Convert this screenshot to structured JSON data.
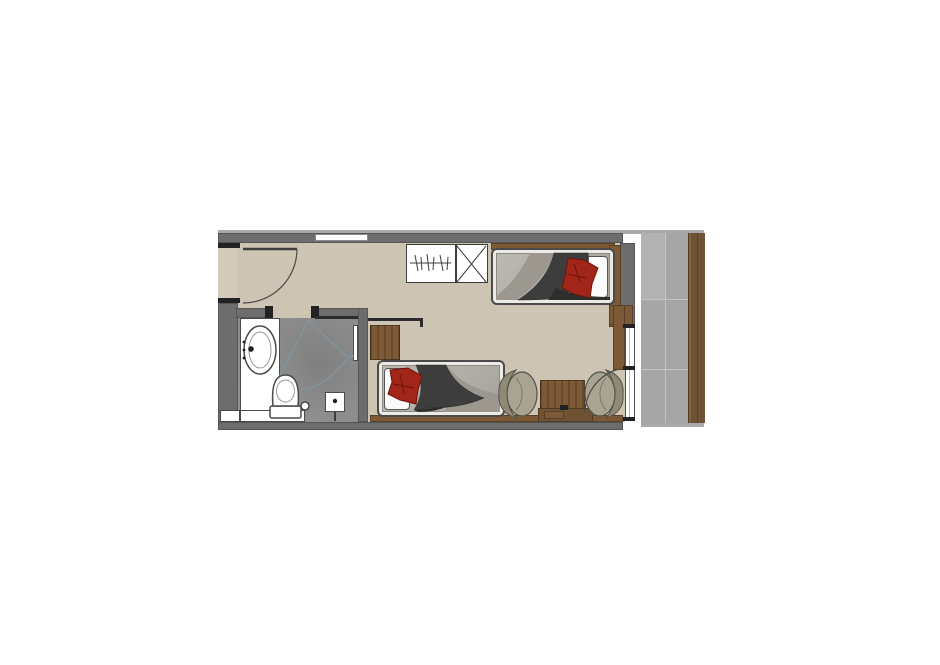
{
  "document": {
    "kind": "hotel-room-floor-plan",
    "visible_text": []
  },
  "plan": {
    "rooms": [
      "entry",
      "bathroom",
      "bedroom",
      "balcony"
    ],
    "furniture": [
      "entry-door",
      "bathroom-sliding-door",
      "vanity-sink",
      "toilet",
      "shower",
      "shower-glass-panel",
      "wardrobe-hanging-rail",
      "wardrobe-shelf-unit",
      "bed-1",
      "bed-2",
      "nightstand",
      "luggage-rack",
      "sideboard-ledge",
      "coffee-table",
      "media-box",
      "armchair-left",
      "armchair-right",
      "balcony-door",
      "balcony-window",
      "balcony-decking"
    ]
  },
  "colors": {
    "page_bg": "#ffffff",
    "wall": "#6d6d6d",
    "wall_cap": "#222222",
    "floor": "#cec4b3",
    "entry_floor": "#d3cabb",
    "bath_floor": "#8d8d8d",
    "tile": "#a6a6a6",
    "tile_light": "#b2b2b2",
    "grout": "#c4c4c4",
    "band": "#a9a9a9",
    "plank": "#6e5233",
    "plank_edge": "#503a22",
    "wood": "#7c5a38",
    "wood_grain": "#6a4a2b",
    "frame": "#eceae4",
    "mattress": "#b4b1a9",
    "blanket_dark": "#3d3d3d",
    "blanket_darker": "#2e2e2e",
    "blanket_light": "#9c988f",
    "pillow": "#fbfbf9",
    "cushion": "#a2251a",
    "cushion_dark": "#701409",
    "chair": "#a9a492",
    "chair_back": "#8f8a76",
    "outline": "#4a4a4a",
    "glass_line": "#8195a1",
    "niche": "#ffffff",
    "white": "#ffffff"
  }
}
